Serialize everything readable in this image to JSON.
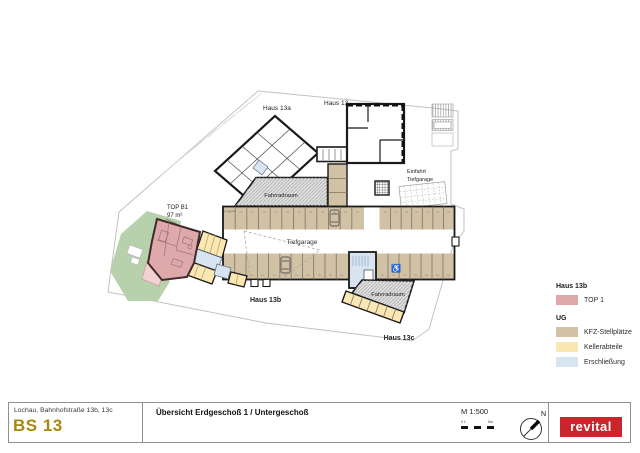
{
  "plan": {
    "labels": {
      "haus_13a": "Haus 13a",
      "haus_13": "Haus 13",
      "haus_13b": "Haus 13b",
      "haus_13c": "Haus 13c",
      "fahrradraum_top": "Fahrradraum",
      "fahrradraum_bottom": "Fahrradraum",
      "tiefgarage": "Tiefgarage",
      "einfahrt_line1": "Einfahrt",
      "einfahrt_line2": "Tiefgarage",
      "top_b1": "TOP B1",
      "top_b1_area": "97 m²",
      "motorrad": "MOTORRAD"
    },
    "parking": {
      "space_label_prefix": "TG.",
      "upper_left_count": 12,
      "upper_right_count": 7,
      "lower_left_count": 11,
      "lower_right_count": 7
    }
  },
  "legend": {
    "group1_heading": "Haus 13b",
    "group1_items": [
      {
        "label": "TOP 1",
        "color": "#DFA9AC"
      }
    ],
    "group2_heading": "UG",
    "group2_items": [
      {
        "label": "KFZ-Stellplätze",
        "color": "#D2C2A5"
      },
      {
        "label": "Kellerabteile",
        "color": "#FAE7B3"
      },
      {
        "label": "Erschließung",
        "color": "#D8E5F1"
      }
    ]
  },
  "titlebar": {
    "address": "Lochau, Bahnhofstraße 13b, 13c",
    "project": "BS 13",
    "title": "Übersicht Erdgeschoß 1 / Untergeschoß",
    "scale": "M 1:500",
    "scalebar_left": "0 1",
    "scalebar_right": "5m",
    "north": "N",
    "logo": "revital"
  },
  "colors": {
    "wall": "#1A1A1A",
    "boundary": "#C2C2C2",
    "top1_pink": "#DFA9AC",
    "terrace_pink": "#F2D3D3",
    "kfz_tan": "#D2C2A5",
    "keller_yellow": "#FAE7B3",
    "erschliessung_blue": "#D8E5F1",
    "green_area": "#B6D1AB",
    "hatch_gray": "#DFDFDF",
    "accent_gold": "#A8870E",
    "logo_red": "#C9252C"
  }
}
